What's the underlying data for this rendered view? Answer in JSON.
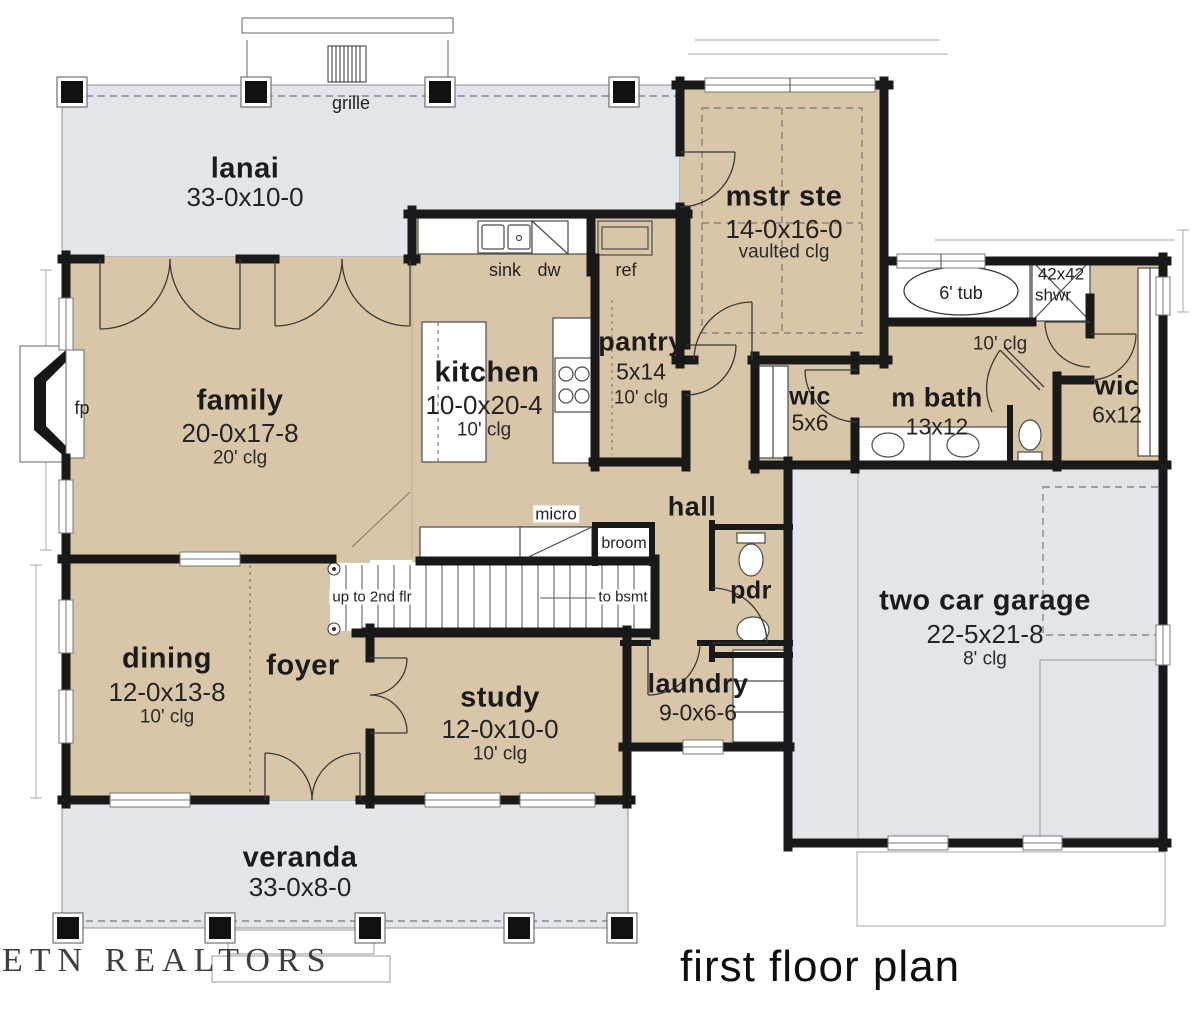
{
  "title": {
    "floor_label": "first floor plan",
    "watermark": "ETN REALTORS"
  },
  "rooms": {
    "lanai": {
      "name": "lanai",
      "dim": "33-0x10-0"
    },
    "mstr": {
      "name": "mstr ste",
      "dim": "14-0x16-0",
      "clg": "vaulted clg"
    },
    "family": {
      "name": "family",
      "dim": "20-0x17-8",
      "clg": "20' clg"
    },
    "kitchen": {
      "name": "kitchen",
      "dim": "10-0x20-4",
      "clg": "10' clg"
    },
    "pantry": {
      "name": "pantry",
      "dim": "5x14",
      "clg": "10' clg"
    },
    "mbath": {
      "name": "m bath",
      "dim": "13x12",
      "clg": "10' clg"
    },
    "wic_small": {
      "name": "wic",
      "dim": "5x6"
    },
    "wic_large": {
      "name": "wic",
      "dim": "6x12"
    },
    "hall": {
      "name": "hall"
    },
    "pdr": {
      "name": "pdr"
    },
    "laundry": {
      "name": "laundry",
      "dim": "9-0x6-6"
    },
    "garage": {
      "name": "two car garage",
      "dim": "22-5x21-8",
      "clg": "8' clg"
    },
    "dining": {
      "name": "dining",
      "dim": "12-0x13-8",
      "clg": "10' clg"
    },
    "foyer": {
      "name": "foyer"
    },
    "study": {
      "name": "study",
      "dim": "12-0x10-0",
      "clg": "10' clg"
    },
    "veranda": {
      "name": "veranda",
      "dim": "33-0x8-0"
    }
  },
  "fixtures": {
    "sink": "sink",
    "dw": "dw",
    "ref": "ref",
    "micro": "micro",
    "broom": "broom",
    "fp": "fp",
    "grille": "grille",
    "tub": "6' tub",
    "shower_size": "42x42",
    "shower": "shwr",
    "stairs_up": "up to 2nd flr",
    "stairs_down": "to bsmt"
  },
  "colors": {
    "room_fill": "#d9c6a9",
    "porch_fill": "#e2e5ea",
    "wall": "#191919",
    "line": "#555555"
  }
}
